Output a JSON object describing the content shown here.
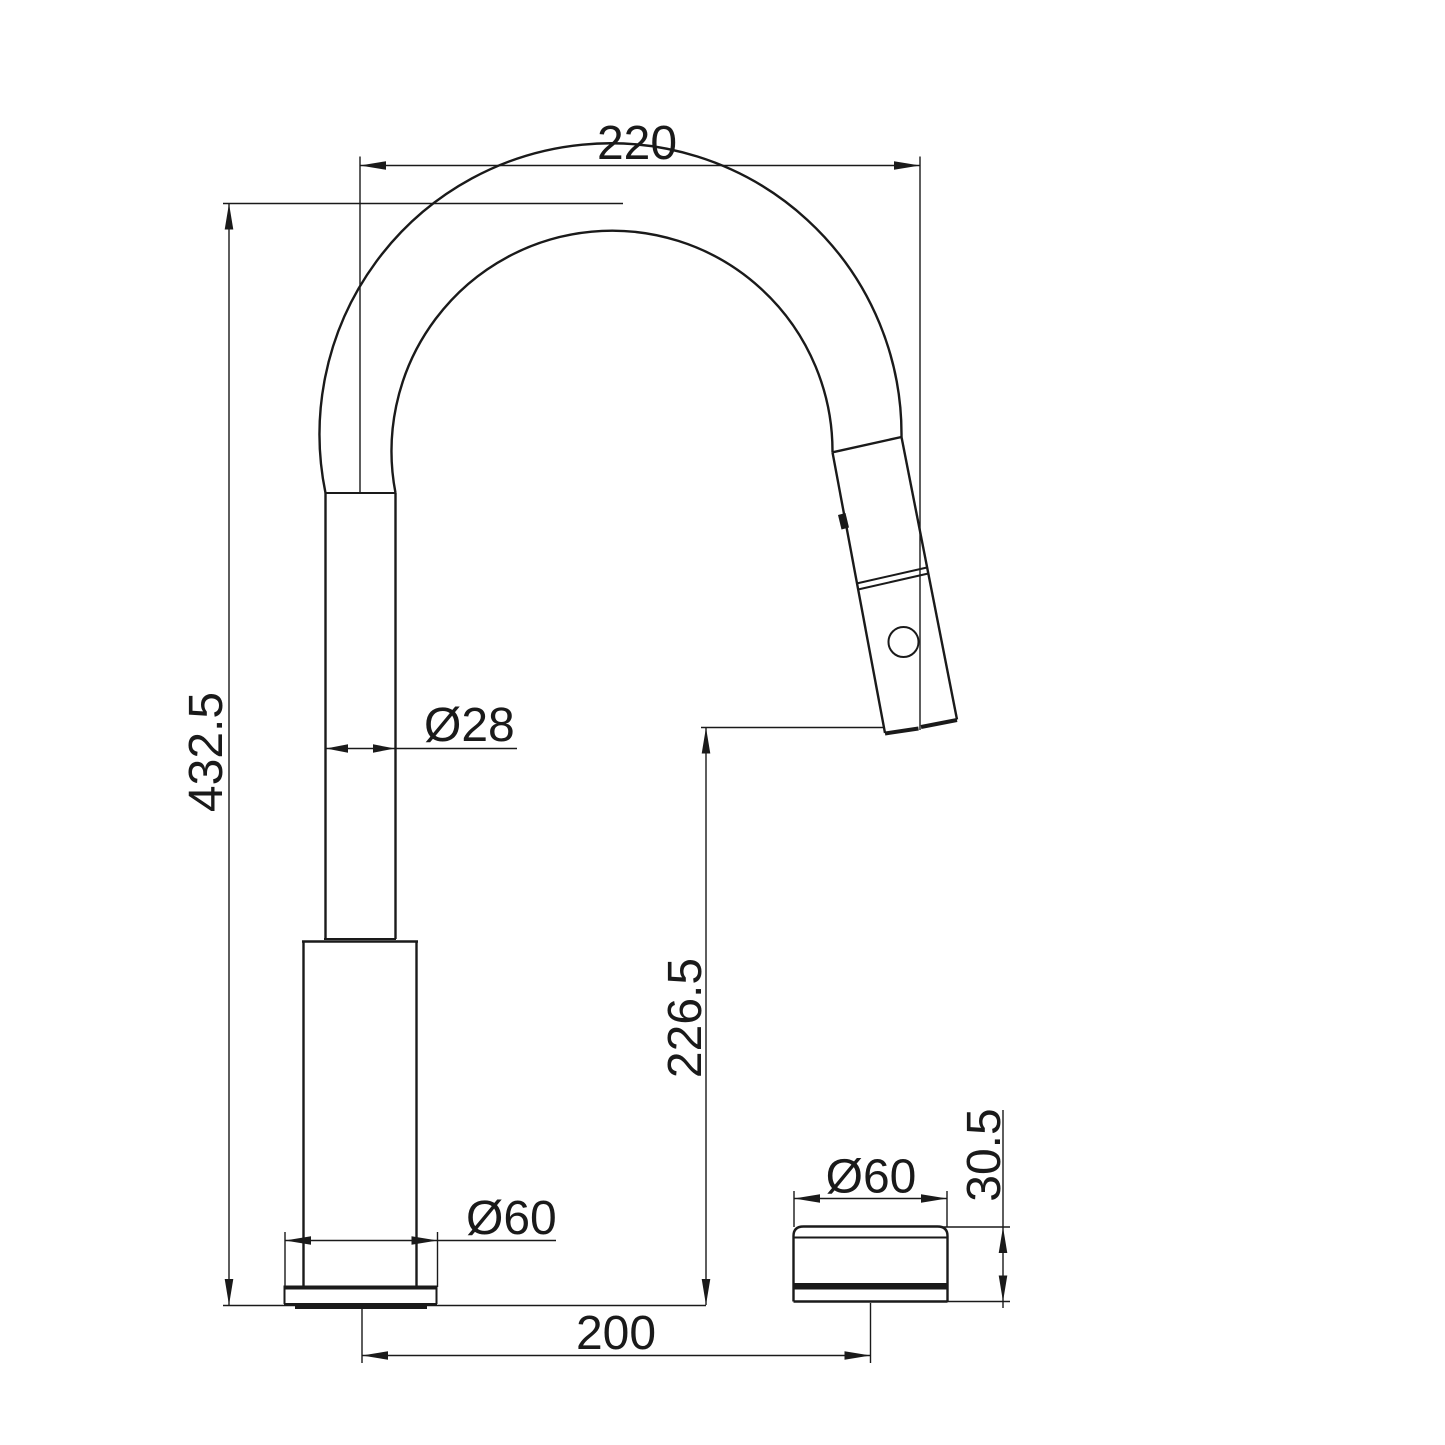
{
  "page": {
    "background": "#ffffff",
    "line_color": "#1a1a1a"
  },
  "drawing": {
    "dimensions": {
      "spout_reach": "220",
      "overall_height": "432.5",
      "pipe_diameter": "Ø28",
      "outlet_height": "226.5",
      "base_diameter": "Ø60",
      "centre_distance": "200",
      "knob_diameter": "Ø60",
      "knob_height": "30.5"
    }
  }
}
